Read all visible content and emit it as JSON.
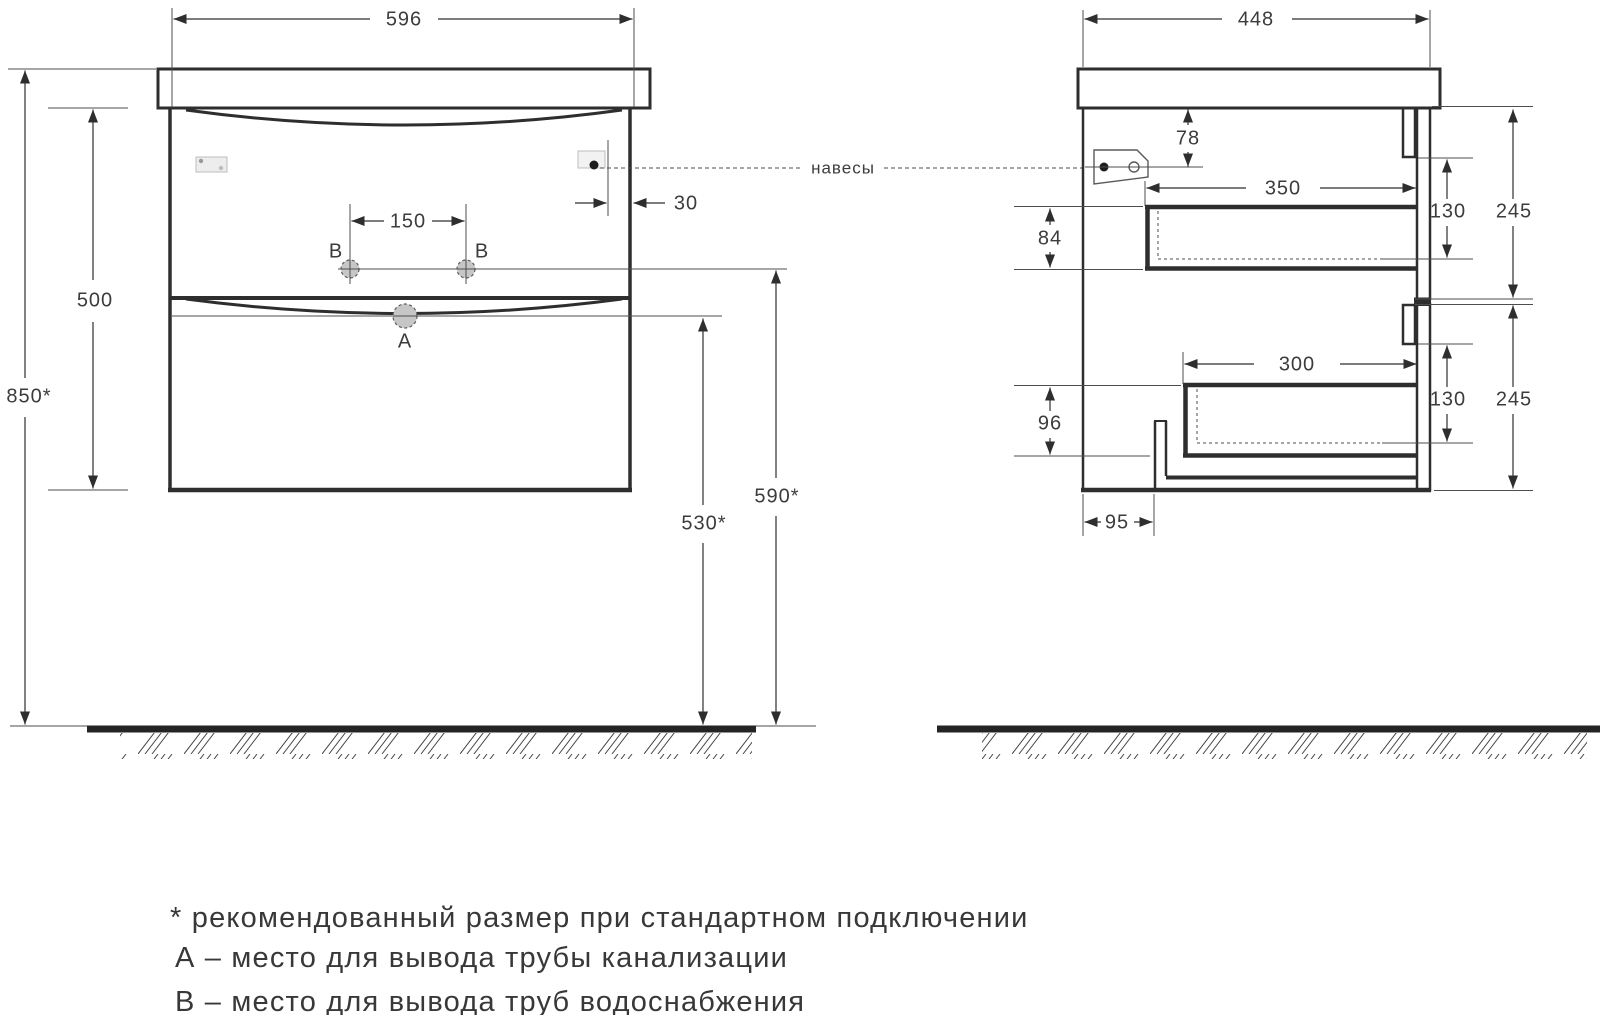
{
  "drawing": {
    "front_view": {
      "width": "596",
      "cabinet_height": "500",
      "total_height": "850*",
      "water_holes_spacing": "150",
      "hanger_edge_offset": "30",
      "drain_height": "530*",
      "water_height": "590*",
      "drain_label": "А",
      "water_label_left": "В",
      "water_label_right": "В"
    },
    "side_view": {
      "depth": "448",
      "hanger_top_drop": "78",
      "upper_drawer_depth": "350",
      "upper_drawer_inner_height": "130",
      "upper_section_height": "245",
      "upper_top_clearance": "84",
      "lower_drawer_depth": "300",
      "lower_drawer_inner_height": "130",
      "lower_section_height": "245",
      "lower_bottom_clearance": "96",
      "pipe_back_offset": "95"
    },
    "callout_hangers": "навесы",
    "notes": {
      "recommended": "* рекомендованный размер при стандартном подключении",
      "legend_a": "А – место для вывода трубы канализации",
      "legend_b": "В – место для вывода труб водоснабжения"
    }
  },
  "colors": {
    "line": "#2e2e2e",
    "thin_line": "#4d4d4d",
    "hole_fill": "#c6c6c6",
    "text": "#3c3c3c"
  }
}
